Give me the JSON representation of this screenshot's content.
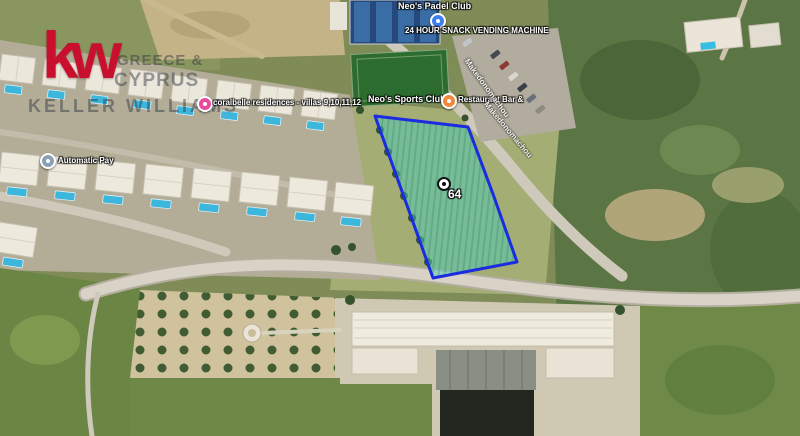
{
  "branding": {
    "logo_text": "kw",
    "logo_color": "#c8102e",
    "watermark": {
      "line1": "GREECE &",
      "line2": "CYPRUS",
      "line3": "KELLER WILLIAMS"
    }
  },
  "map": {
    "type": "satellite-imagery",
    "labels": {
      "padel_club": "Neo's Padel Club",
      "vending_machine": "24 HOUR SNACK VENDING MACHINE",
      "residences": "coralbelle residences - villas 9,10,11,12",
      "sports_club": "Neo's Sports Club",
      "restaurant": "Restaurant Bar &",
      "automatic_pay": "Automatic Pay",
      "road_1": "Makedonomachou",
      "road_2": "Makedonomachou"
    },
    "marker_colors": {
      "vending_machine": "#3d7ef2",
      "residences": "#e94a9c",
      "restaurant": "#f2883d",
      "automatic_pay": "#8aa0b5"
    },
    "parcel": {
      "number": "64",
      "outline_color": "#1b2be0",
      "fill_color": "#49cdb9"
    }
  }
}
